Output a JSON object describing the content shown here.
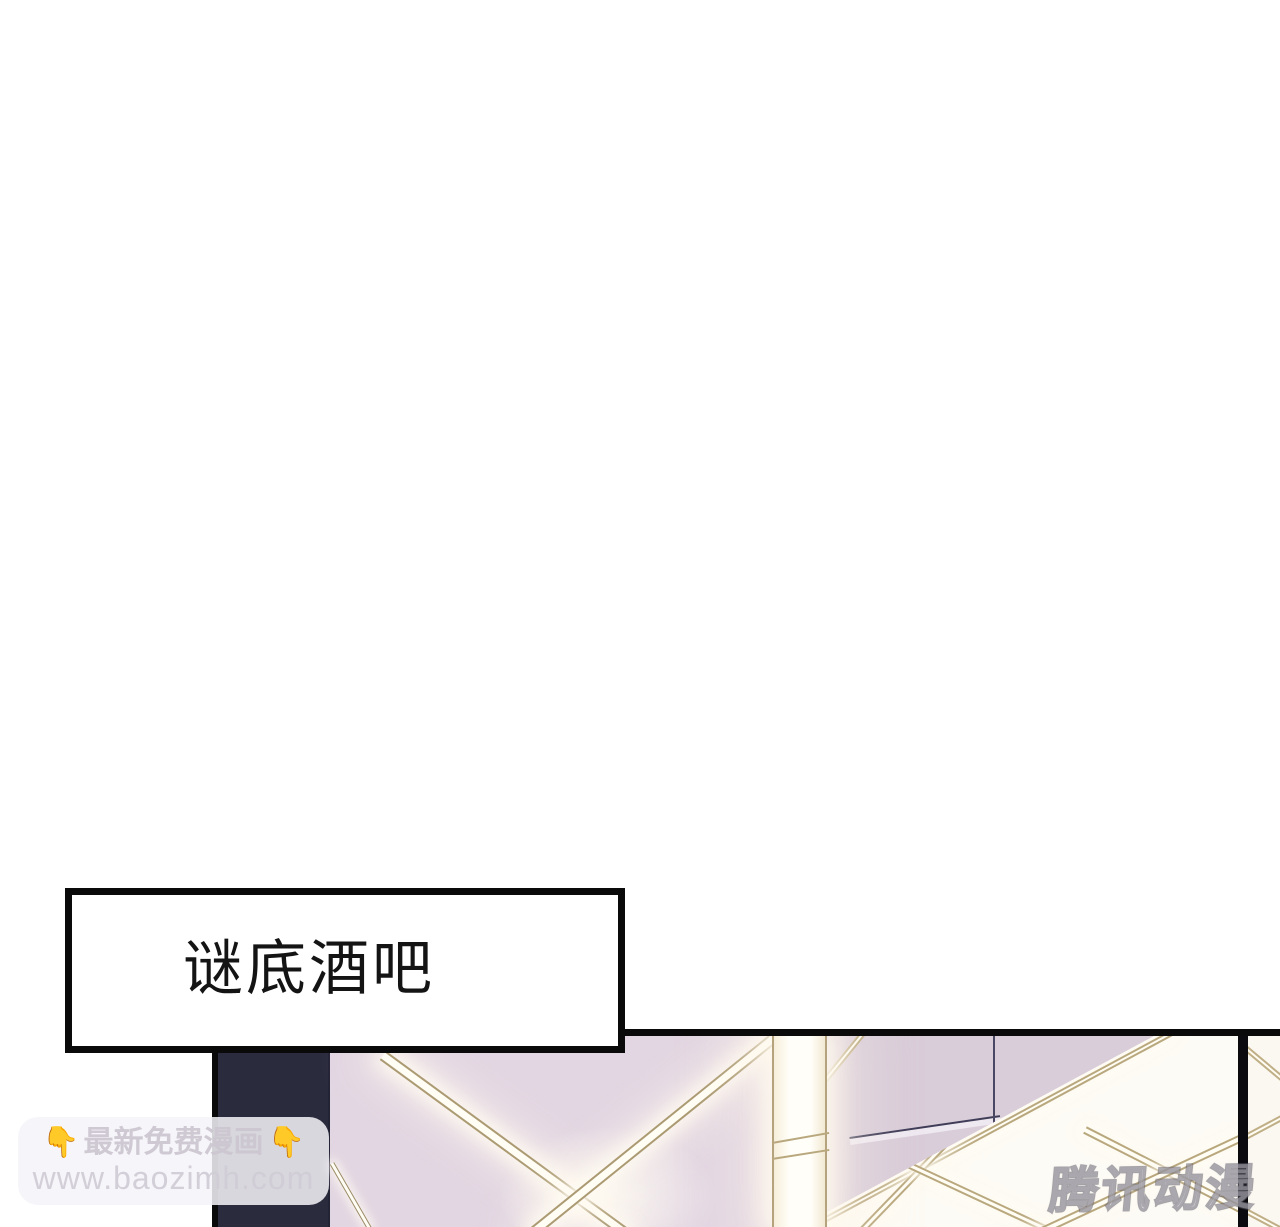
{
  "caption_box": {
    "text": "谜底酒吧"
  },
  "watermark_baozimh": {
    "emoji": "👇",
    "line1": "最新免费漫画",
    "line2": "www.baozimh.com"
  },
  "watermark_tencent": {
    "text": "腾讯动漫"
  },
  "panel": {
    "colors": {
      "page_background": "#ffffff",
      "panel_border": "#0a0a0a",
      "dark_column": "#2b2b3e",
      "pink_wall": "#e2d6e2",
      "mauve_wall": "#d9cdd9",
      "gold_trim": "#ab9a72",
      "light_core": "#fffdf4",
      "window_white": "#fdfbf5",
      "emoji_yellow": "#f3bf3e"
    }
  }
}
